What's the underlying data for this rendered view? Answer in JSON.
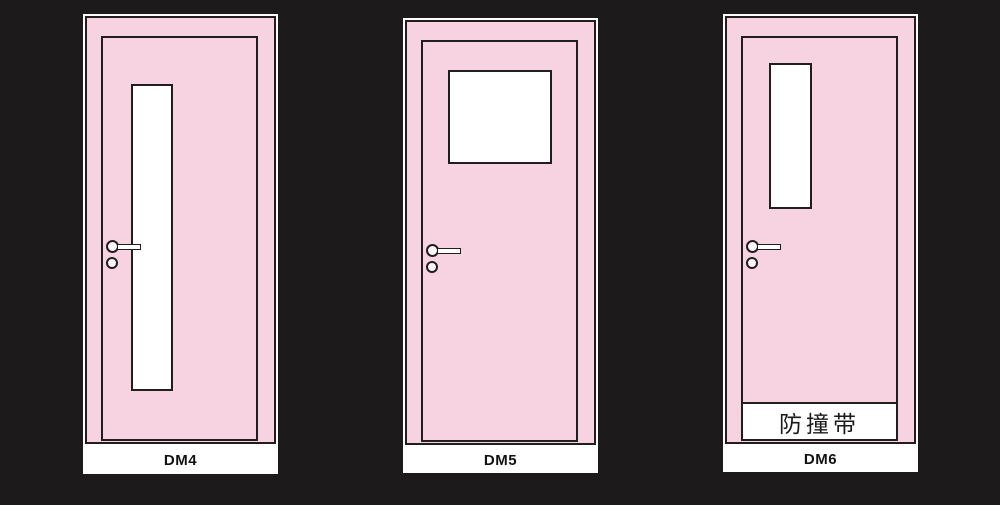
{
  "colors": {
    "background": "#1c1a1a",
    "door_fill": "#f7d3e2",
    "line": "#221e20",
    "glass": "#ffffff",
    "label_bg": "#ffffff",
    "label_text": "#111111"
  },
  "doors": [
    {
      "label": "DM4",
      "glass_panel": "narrow-full-height-left"
    },
    {
      "label": "DM5",
      "glass_panel": "square-top-center"
    },
    {
      "label": "DM6",
      "glass_panel": "narrow-top-left",
      "bumper_label": "防撞带"
    }
  ]
}
